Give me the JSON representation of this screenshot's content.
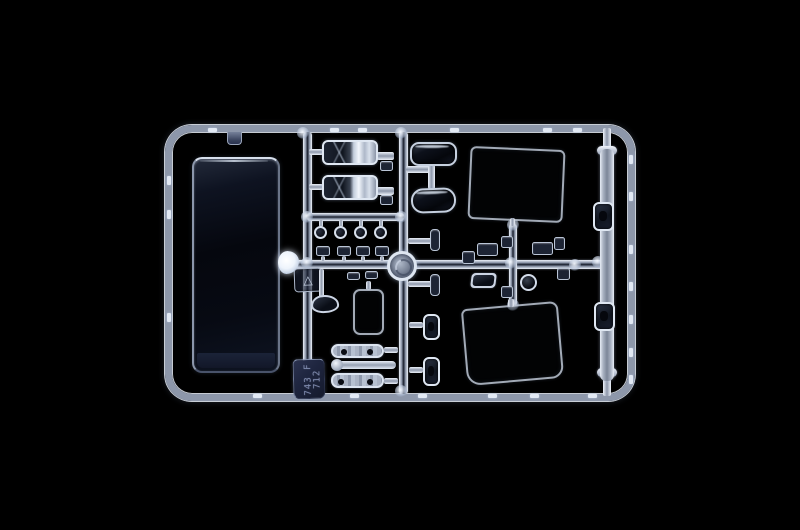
{
  "scene": {
    "kind": "photograph",
    "subject": "clear transparent plastic model-kit parts sprue on a black background"
  },
  "sprue": {
    "tag": {
      "line1": "743 F",
      "line2": "712"
    },
    "recycle_icon_glyph": "△",
    "colors": {
      "background": "#000000",
      "plastic_bright": "#edf2fa",
      "plastic_mid": "#8d97aa",
      "plastic_dark": "#161c2a",
      "glass_dark": "#06080f",
      "chrome_light": "#f2f6fc",
      "tag_bg": "#1f2640",
      "tag_text": "#7d88ac",
      "gate_white": "#ffffff"
    }
  }
}
